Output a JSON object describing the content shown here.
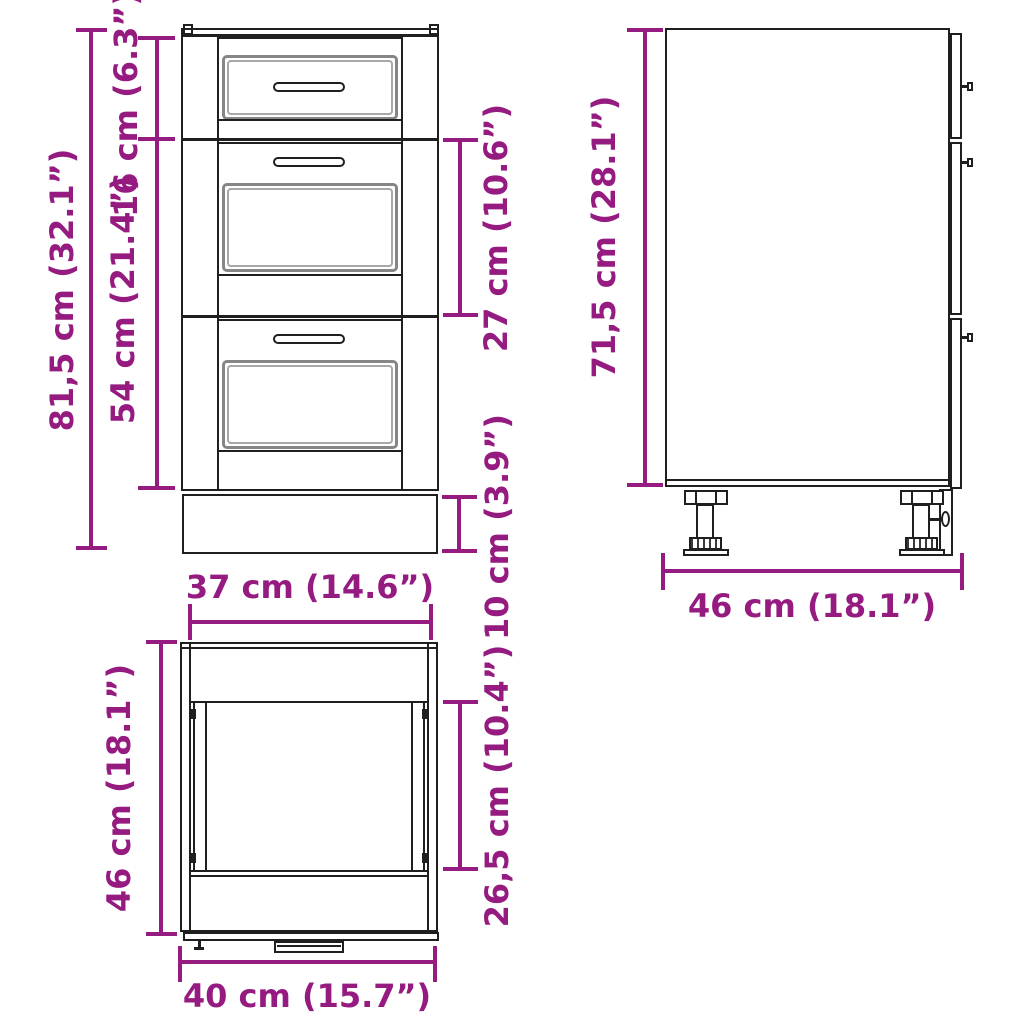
{
  "colors": {
    "accent": "#951b81",
    "line": "#1f1f1f",
    "panel_gray": "#868686",
    "background": "#ffffff"
  },
  "front_view": {
    "labels": {
      "total_height": "81,5 cm (32.1”)",
      "top_drawer_height": "16 cm (6.3”)",
      "lower_drawers_height": "54 cm (21.4”)",
      "middle_drawer_height": "27 cm (10.6”)",
      "plinth_height": "10 cm (3.9”)"
    }
  },
  "side_view": {
    "labels": {
      "body_height": "71,5 cm (28.1”)",
      "depth": "46 cm (18.1”)"
    }
  },
  "top_view": {
    "labels": {
      "inner_width": "37 cm (14.6”)",
      "outer_depth": "46 cm (18.1”)",
      "inner_depth": "26,5 cm (10.4”)",
      "outer_width": "40 cm (15.7”)"
    }
  }
}
